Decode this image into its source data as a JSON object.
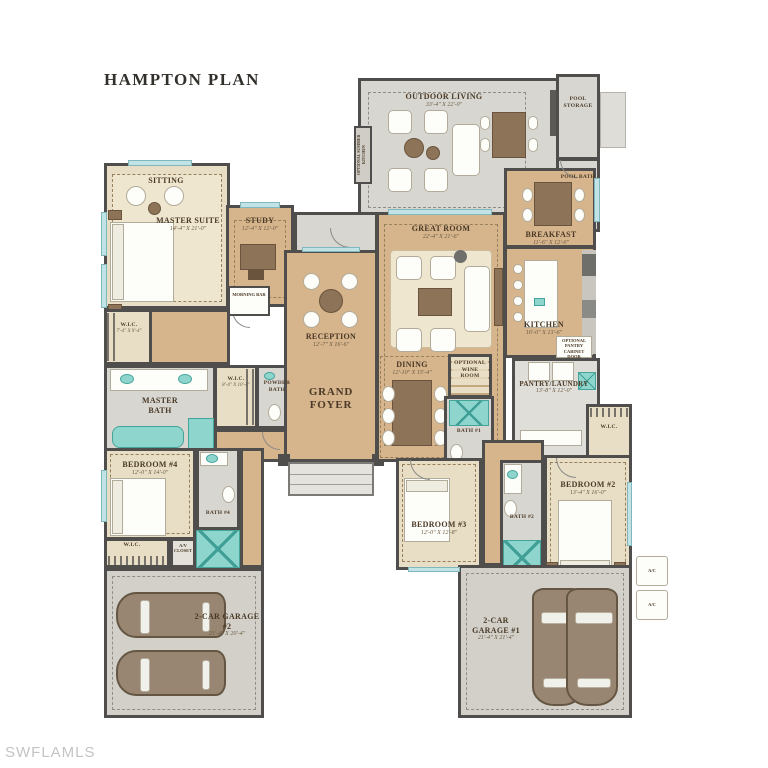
{
  "header": {
    "title": "HAMPTON PLAN"
  },
  "watermark": {
    "text": "SWFLAMLS"
  },
  "colors": {
    "wood_floor": "#d6b48c",
    "carpet": "#e8dec6",
    "tile": "#d8d6d0",
    "garage_floor": "#d2d0c9",
    "wall": "#4f4e4c",
    "window_glass": "#c2e3e6",
    "plumbing_fixture": "#8ed5cd",
    "fixture_accent": "#44a49a",
    "label_text": "#4a3926",
    "title_text": "#33302c",
    "watermark_text": "#c4c4c4",
    "car_body": "#998672"
  },
  "rooms": {
    "sitting": {
      "label": "SITTING"
    },
    "master_suite": {
      "label": "MASTER SUITE",
      "dims": "14'-4\" X 21'-0\""
    },
    "study": {
      "label": "STUDY",
      "dims": "12'-4\" X 12'-0\""
    },
    "morning_bar": {
      "label": "MORNING BAR"
    },
    "wic_master": {
      "label": "W.I.C.",
      "dims": "7'-4\" X 9'-4\""
    },
    "master_bath": {
      "label": "MASTER BATH"
    },
    "wic_hall": {
      "label": "W.I.C.",
      "dims": "8'-4\" X 10'-4\""
    },
    "powder_bath": {
      "label": "POWDER BATH"
    },
    "reception": {
      "label": "RECEPTION",
      "dims": "12'-7\" X 16'-6\""
    },
    "grand_foyer": {
      "label": "GRAND FOYER"
    },
    "great_room": {
      "label": "GREAT ROOM",
      "dims": "22'-4\" X 21'-6\""
    },
    "dining": {
      "label": "DINING",
      "dims": "12'-10\" X 15'-4\""
    },
    "breakfast": {
      "label": "BREAKFAST",
      "dims": "11'-6\" X 12'-0\""
    },
    "kitchen": {
      "label": "KITCHEN",
      "dims": "16'-0\" X 13'-6\""
    },
    "outdoor_living": {
      "label": "OUTDOOR LIVING",
      "dims": "33'-4\" X 22'-0\""
    },
    "summer_kitchen": {
      "label": "OPTIONAL SUMMER KITCHEN"
    },
    "pool_storage": {
      "label": "POOL STORAGE"
    },
    "pool_bath": {
      "label": "POOL BATH"
    },
    "pantry_laundry": {
      "label": "PANTRY/LAUNDRY",
      "dims": "13'-8\" X 12'-0\""
    },
    "pantry_note": {
      "label": "OPTIONAL PANTRY CABINET DOOR"
    },
    "wine_room": {
      "label": "OPTIONAL WINE ROOM"
    },
    "bath1": {
      "label": "BATH #1"
    },
    "wic_bed2": {
      "label": "W.I.C."
    },
    "bedroom2": {
      "label": "BEDROOM #2",
      "dims": "13'-4\" X 16'-0\""
    },
    "bath2": {
      "label": "BATH #2"
    },
    "bedroom3": {
      "label": "BEDROOM #3",
      "dims": "12'-0\" X 12'-8\""
    },
    "bedroom4": {
      "label": "BEDROOM #4",
      "dims": "12'-0\" X 14'-0\""
    },
    "bath4": {
      "label": "BATH #4"
    },
    "wic_bed4": {
      "label": "W.I.C."
    },
    "av_closet": {
      "label": "A/V CLOSET"
    },
    "garage2": {
      "label": "2-CAR GARAGE #2",
      "dims": "21'-4\" X 20'-4\""
    },
    "garage1": {
      "label": "2-CAR GARAGE #1",
      "dims": "21'-4\" X 21'-4\""
    },
    "ac": {
      "label": "A/C"
    }
  }
}
